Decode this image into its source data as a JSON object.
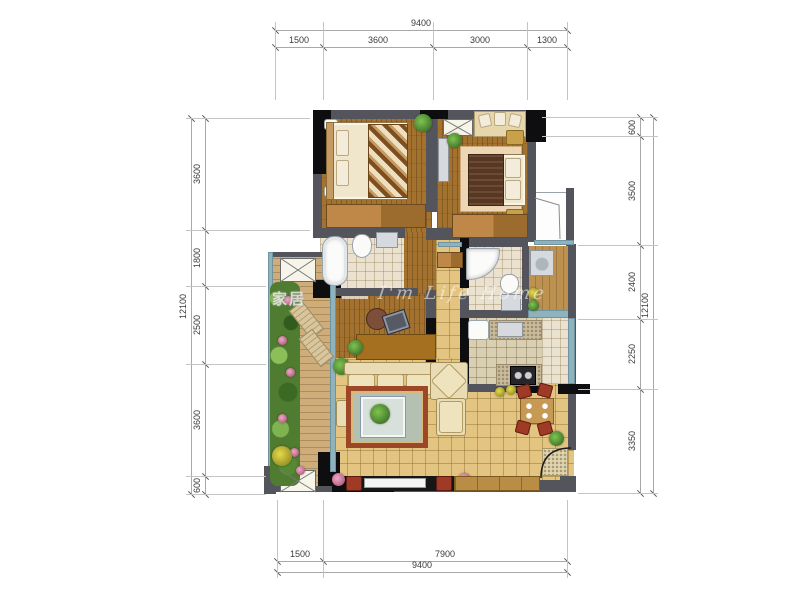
{
  "meta": {
    "type": "apartment-floor-plan"
  },
  "watermark": {
    "cjk": "家居",
    "script": "I'm Life Home"
  },
  "dimensions": {
    "top": {
      "total": "9400",
      "segments": [
        "1500",
        "3600",
        "3000",
        "1300"
      ]
    },
    "bottom": {
      "total": "9400",
      "segments": [
        "1500",
        "7900"
      ]
    },
    "left": {
      "total": "12100",
      "segments": [
        "3600",
        "1800",
        "2500",
        "3600",
        "600"
      ]
    },
    "right": {
      "total": "12100",
      "segments": [
        "600",
        "3500",
        "2400",
        "2250",
        "3350"
      ]
    }
  },
  "colors": {
    "wall_gray": "#54545c",
    "wall_black": "#0e0e10",
    "window_glass": "#8fb3bd",
    "wood_floor": "#a3722e",
    "living_tile": "#e3c480",
    "rug_border": "#9c4828",
    "accent_red": "#9e3a26",
    "dim_line": "#a8a8a8",
    "dim_text": "#3a3a3a"
  }
}
